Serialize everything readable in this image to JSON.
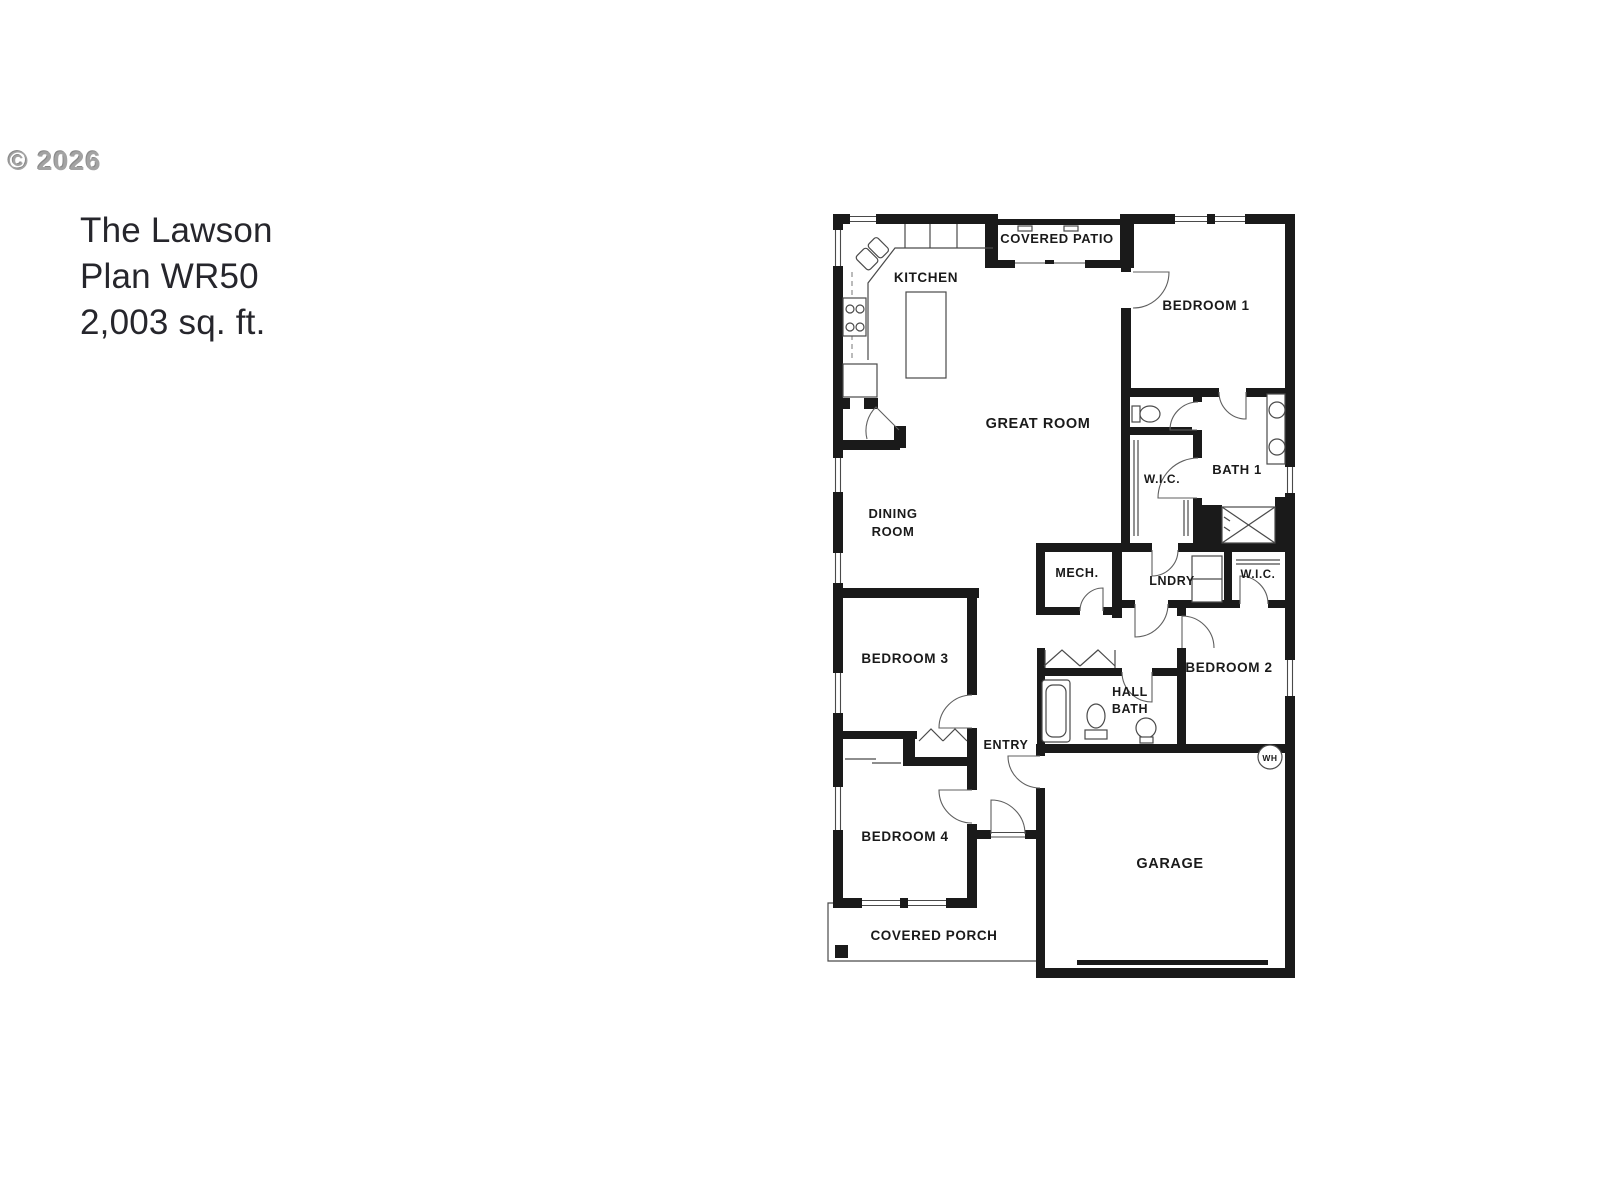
{
  "watermark": "© 2026",
  "title": {
    "line1": "The Lawson",
    "line2": "Plan WR50",
    "line3": "2,003 sq. ft."
  },
  "plan": {
    "rooms": {
      "kitchen": "KITCHEN",
      "covered_patio": "COVERED PATIO",
      "bedroom1": "BEDROOM 1",
      "great_room": "GREAT ROOM",
      "wic_primary": "W.I.C.",
      "bath1": "BATH 1",
      "dining_line1": "DINING",
      "dining_line2": "ROOM",
      "mech": "MECH.",
      "laundry": "LNDRY",
      "wic_bedroom2": "W.I.C.",
      "bedroom3": "BEDROOM 3",
      "bedroom2": "BEDROOM 2",
      "hall_bath_line1": "HALL",
      "hall_bath_line2": "BATH",
      "entry": "ENTRY",
      "bedroom4": "BEDROOM 4",
      "garage": "GARAGE",
      "covered_porch": "COVERED PORCH",
      "water_heater": "WH"
    },
    "colors": {
      "wall": "#1a1a1a",
      "line": "#4a4a4a",
      "label": "#1a1a1a"
    }
  }
}
